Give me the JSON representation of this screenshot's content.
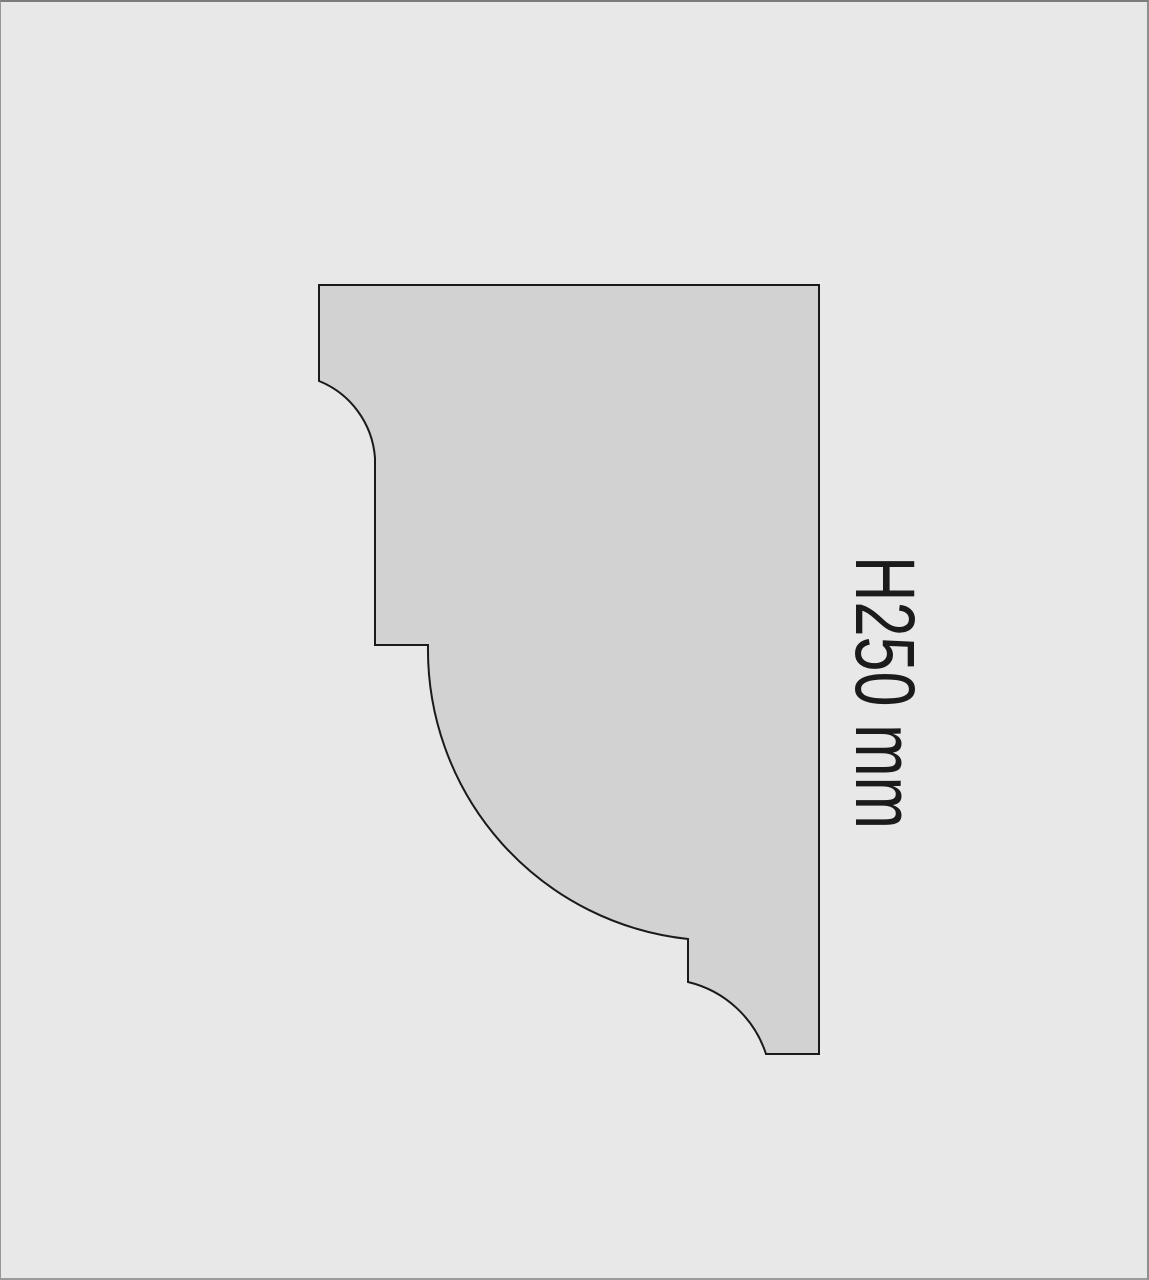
{
  "diagram": {
    "dimension_label": "H250 mm"
  },
  "colors": {
    "background": "#e8e8e8",
    "shape_fill": "#d2d2d2",
    "shape_outline": "#1a1a1a",
    "label_text": "#1b1b1b",
    "frame_top": "#7c7c7c",
    "frame_right": "#8e8e8e",
    "frame_bottom": "#9b9b9b",
    "frame_left": "#989898"
  }
}
